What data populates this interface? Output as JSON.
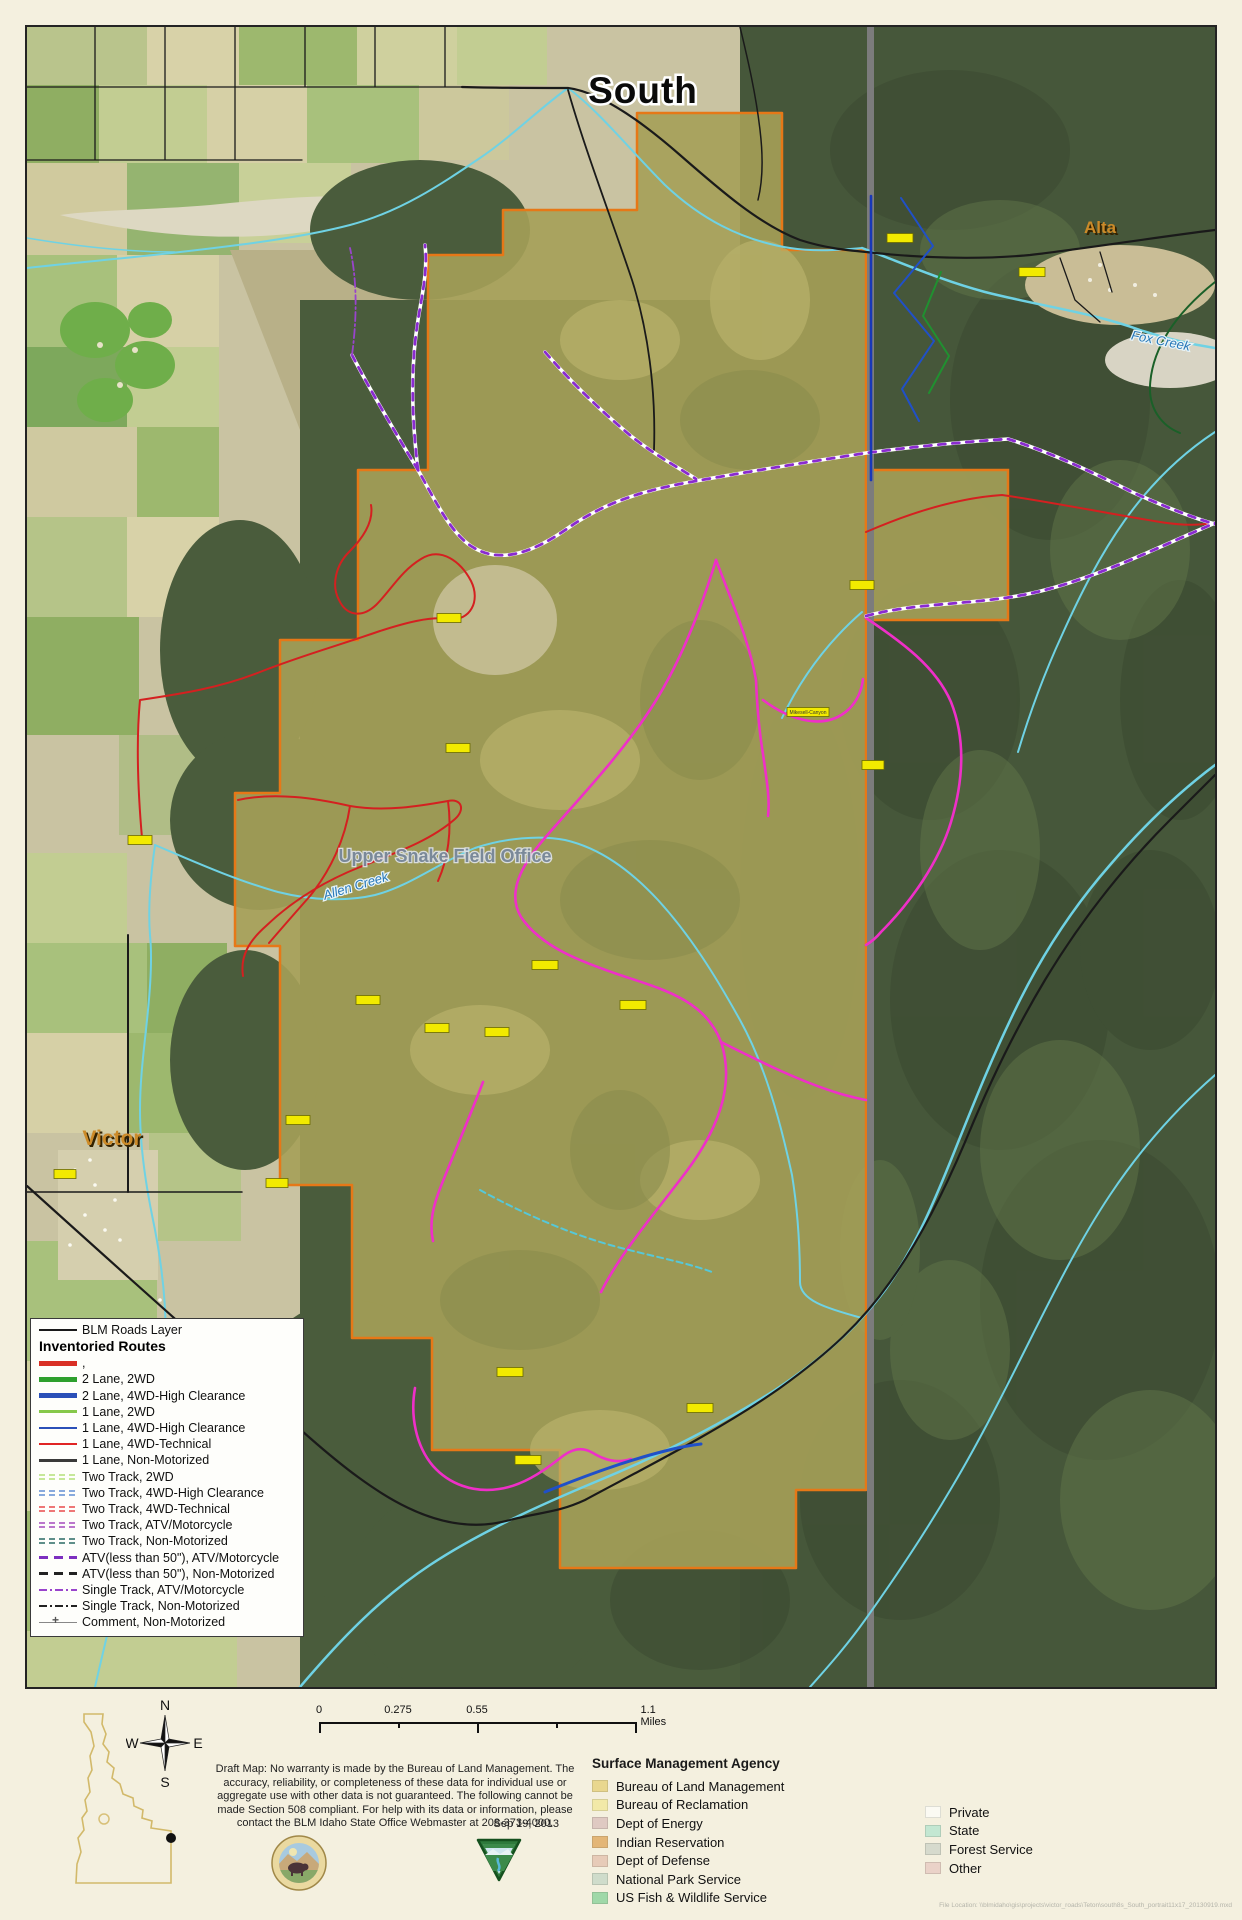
{
  "map": {
    "title": "South",
    "place_labels": {
      "alta": "Alta",
      "victor": "Victor",
      "fox_creek": "Fox Creek",
      "allen_creek": "Allen Creek",
      "field_office": "Upper Snake Field Office"
    },
    "route_id_labels": [
      {
        "x": 900,
        "y": 238,
        "w": 26,
        "text": ""
      },
      {
        "x": 1032,
        "y": 272,
        "w": 26,
        "text": ""
      },
      {
        "x": 449,
        "y": 618,
        "w": 24,
        "text": ""
      },
      {
        "x": 140,
        "y": 840,
        "w": 24,
        "text": ""
      },
      {
        "x": 808,
        "y": 712,
        "w": 42,
        "text": "Mikesell-Canyon"
      },
      {
        "x": 873,
        "y": 765,
        "w": 22,
        "text": ""
      },
      {
        "x": 458,
        "y": 748,
        "w": 24,
        "text": ""
      },
      {
        "x": 862,
        "y": 585,
        "w": 24,
        "text": ""
      },
      {
        "x": 545,
        "y": 965,
        "w": 26,
        "text": ""
      },
      {
        "x": 368,
        "y": 1000,
        "w": 24,
        "text": ""
      },
      {
        "x": 437,
        "y": 1028,
        "w": 24,
        "text": ""
      },
      {
        "x": 497,
        "y": 1032,
        "w": 24,
        "text": ""
      },
      {
        "x": 633,
        "y": 1005,
        "w": 26,
        "text": ""
      },
      {
        "x": 298,
        "y": 1120,
        "w": 24,
        "text": ""
      },
      {
        "x": 65,
        "y": 1174,
        "w": 22,
        "text": ""
      },
      {
        "x": 277,
        "y": 1183,
        "w": 22,
        "text": ""
      },
      {
        "x": 510,
        "y": 1372,
        "w": 26,
        "text": ""
      },
      {
        "x": 700,
        "y": 1408,
        "w": 26,
        "text": ""
      },
      {
        "x": 528,
        "y": 1460,
        "w": 26,
        "text": ""
      }
    ],
    "colors": {
      "blm_parcel": "#a5a058",
      "parcel_border": "#e67817",
      "state_line": "#7c7c7c",
      "stream": "#6fd2e4",
      "magenta_route": "#ef2fc8",
      "atv_route": "#8a2bd0"
    }
  },
  "legend": {
    "roads_layer": {
      "label": "BLM Roads Layer",
      "color": "#1a1a1a"
    },
    "title": "Inventoried Routes",
    "entries": [
      {
        "style": "line",
        "weight": 5,
        "color": "#d93025",
        "label": ","
      },
      {
        "style": "line",
        "weight": 5,
        "color": "#2ea02e",
        "label": "2 Lane, 2WD"
      },
      {
        "style": "line",
        "weight": 5,
        "color": "#2b50b8",
        "label": "2 Lane, 4WD-High Clearance"
      },
      {
        "style": "line",
        "weight": 3,
        "color": "#86c84a",
        "label": "1 Lane, 2WD"
      },
      {
        "style": "line",
        "weight": 2.5,
        "color": "#2b50b8",
        "label": "1 Lane, 4WD-High Clearance"
      },
      {
        "style": "line",
        "weight": 2.5,
        "color": "#e02424",
        "label": "1 Lane, 4WD-Technical"
      },
      {
        "style": "line",
        "weight": 3,
        "color": "#3a3a3a",
        "label": "1 Lane, Non-Motorized"
      },
      {
        "style": "twotrack",
        "color": "#c6e89a",
        "label": "Two Track, 2WD"
      },
      {
        "style": "twotrack",
        "color": "#88aadd",
        "label": "Two Track, 4WD-High Clearance"
      },
      {
        "style": "twotrack",
        "color": "#ee7777",
        "label": "Two Track, 4WD-Technical"
      },
      {
        "style": "twotrack",
        "color": "#bb77cc",
        "label": "Two Track, ATV/Motorcycle"
      },
      {
        "style": "twotrack",
        "color": "#5f8f8a",
        "label": "Two Track, Non-Motorized"
      },
      {
        "style": "dash",
        "color": "#7d2fc0",
        "label": "ATV(less than 50\"), ATV/Motorcycle"
      },
      {
        "style": "dash",
        "color": "#222222",
        "label": "ATV(less than 50\"), Non-Motorized"
      },
      {
        "style": "dashdot",
        "color": "#9944cc",
        "label": "Single Track, ATV/Motorcycle"
      },
      {
        "style": "dashdot",
        "color": "#222222",
        "label": "Single Track, Non-Motorized"
      },
      {
        "style": "cross",
        "color": "#888888",
        "label": "Comment, Non-Motorized"
      }
    ]
  },
  "scale_bar": {
    "labels": [
      "0",
      "0.275",
      "0.55"
    ],
    "end_label": "1.1 Miles"
  },
  "compass": {
    "north": "N",
    "south": "S",
    "east": "E",
    "west": "W"
  },
  "notes": {
    "disclaimer": "Draft Map:  No warranty is made by the Bureau of Land Management. The accuracy, reliability, or completeness of these data for individual use or aggregate use with other data is not guaranteed.  The following cannot be made Section 508 compliant.  For help with its data or information, please contact the BLM Idaho State Office Webmaster at 208-373-4000.",
    "date": "Sep 19, 2013"
  },
  "agency_legend": {
    "title": "Surface Management Agency",
    "column1": [
      {
        "label": "Bureau of Land Management",
        "color": "#e9d78e"
      },
      {
        "label": "Bureau of Reclamation",
        "color": "#f2e9a8"
      },
      {
        "label": "Dept of Energy",
        "color": "#dfc9c2"
      },
      {
        "label": "Indian Reservation",
        "color": "#e3b677"
      },
      {
        "label": "Dept of Defense",
        "color": "#e7cbb8"
      },
      {
        "label": "National Park Service",
        "color": "#cfdccb"
      },
      {
        "label": "US Fish & Wildlife Service",
        "color": "#9fd8a8"
      }
    ],
    "column2": [
      {
        "label": "Private",
        "color": "#fbfaf3"
      },
      {
        "label": "State",
        "color": "#c3e7d2"
      },
      {
        "label": "Forest Service",
        "color": "#d6dacd"
      },
      {
        "label": "Other",
        "color": "#ead2c8"
      }
    ]
  },
  "footer": {
    "file_location": "File Location: \\\\blmidaho\\gis\\projects\\victor_roads\\Teton\\south8s_South_portrait11x17_20130919.mxd"
  }
}
